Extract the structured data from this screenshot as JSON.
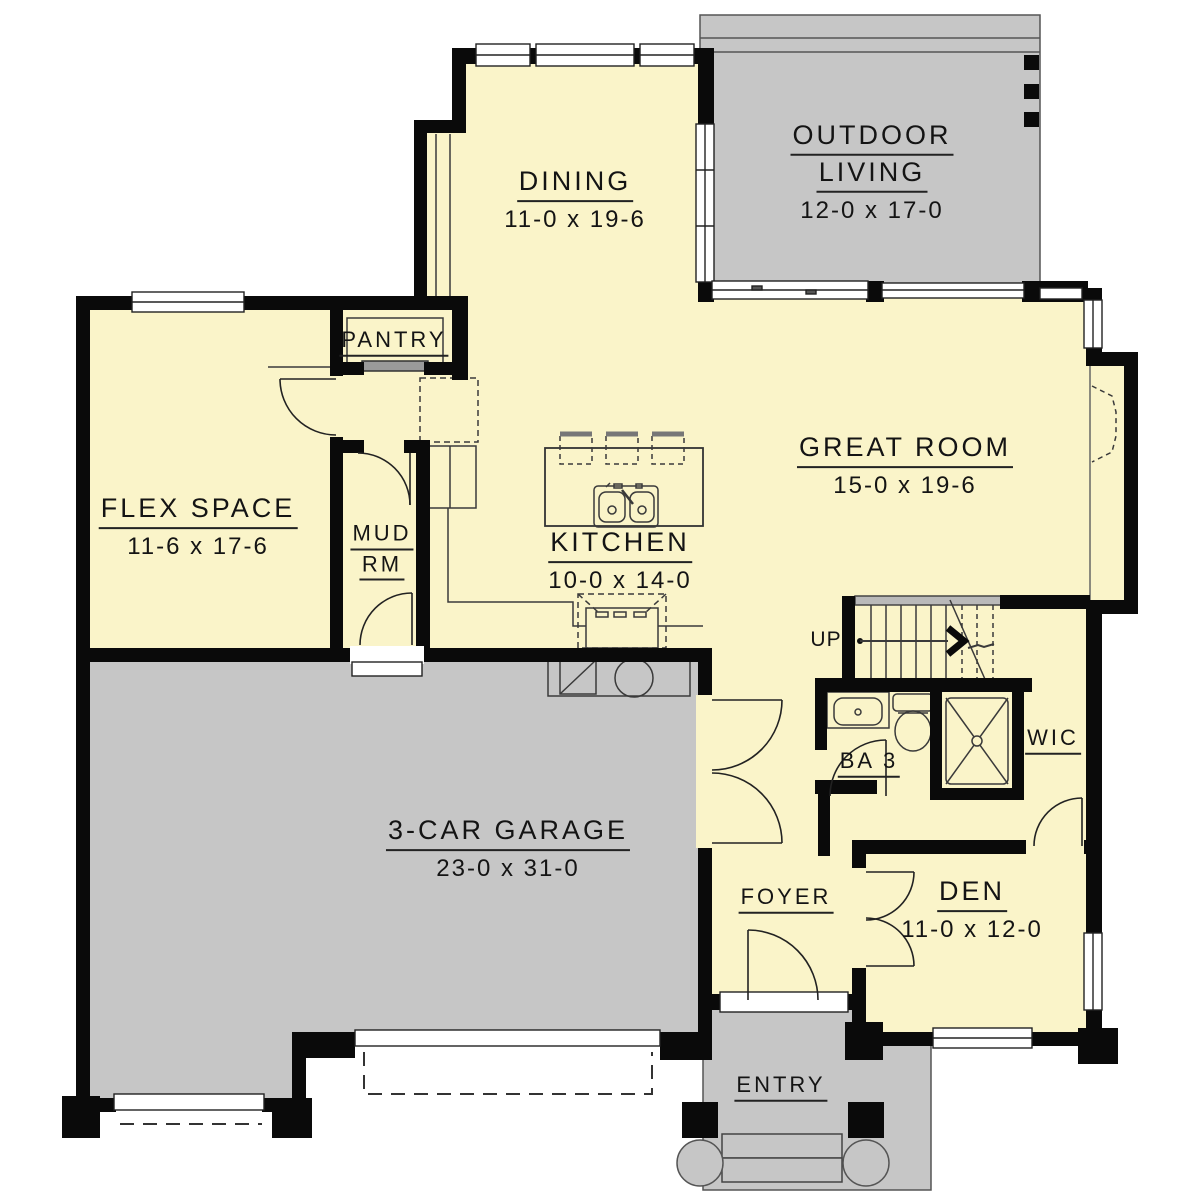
{
  "plan": {
    "type": "residential-first-floor-plan",
    "colors": {
      "room_fill": "#FAF4C9",
      "exterior_gray": "#C6C6C6",
      "wall": "#000000",
      "background": "#FFFFFF",
      "label_text": "#141414"
    },
    "rooms": {
      "dining": {
        "name": "DINING",
        "dims": "11-0 x 19-6"
      },
      "outdoor_living": {
        "line1": "OUTDOOR",
        "line2": "LIVING",
        "dims": "12-0 x 17-0"
      },
      "pantry": {
        "name": "PANTRY"
      },
      "flex": {
        "name": "FLEX SPACE",
        "dims": "11-6 x 17-6"
      },
      "mud": {
        "line1": "MUD",
        "line2": "RM"
      },
      "kitchen": {
        "name": "KITCHEN",
        "dims": "10-0 x 14-0"
      },
      "great_room": {
        "name": "GREAT ROOM",
        "dims": "15-0 x 19-6"
      },
      "stairs": {
        "label": "UP"
      },
      "ba3": {
        "name": "BA 3"
      },
      "wic": {
        "name": "WIC"
      },
      "garage": {
        "name": "3-CAR GARAGE",
        "dims": "23-0 x 31-0"
      },
      "foyer": {
        "name": "FOYER"
      },
      "den": {
        "name": "DEN",
        "dims": "11-0 x 12-0"
      },
      "entry": {
        "name": "ENTRY"
      }
    }
  }
}
